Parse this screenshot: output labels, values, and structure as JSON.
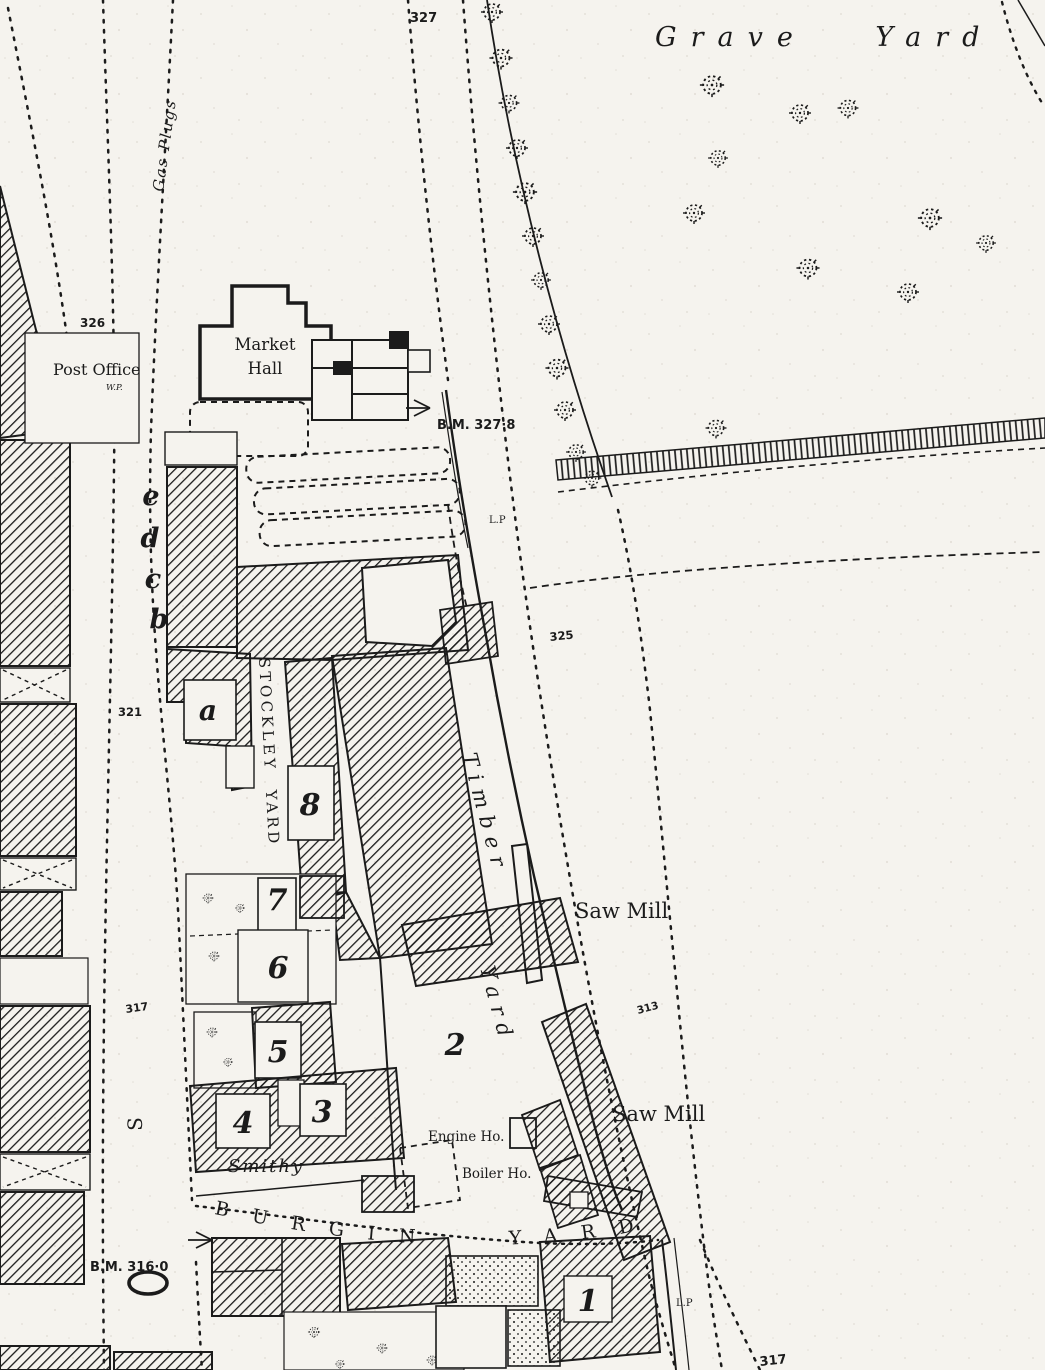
{
  "map": {
    "labels": {
      "grave_yard": "Grave Yard",
      "gas_plugs": "Gas Plugs",
      "post_office": "Post Office",
      "post_office_mark": "W.P.",
      "market_hall_line1": "Market",
      "market_hall_line2": "Hall",
      "benchmark_upper": "B.M. 327·8",
      "lamp_post_upper": "L.P",
      "stockley_yard": "STOCKLEY YARD",
      "timber": "Timber",
      "timber_yard": "Yard",
      "saw_mill_upper": "Saw Mill",
      "saw_mill_lower": "Saw Mill",
      "engine_house": "Engine Ho.",
      "boiler_house": "Boiler Ho.",
      "smithy": "Smithy",
      "burgin_yard": "BURGIN YARD",
      "benchmark_lower": "B.M. 316·0",
      "lamp_post_lower": "L.P",
      "street_letter": "S"
    },
    "spot_heights": {
      "h327": "327",
      "h326": "326",
      "h325": "325",
      "h321": "321",
      "h317": "317",
      "h313": "313",
      "h317_south": "317"
    },
    "red_annotations": {
      "a": "a",
      "b": "b",
      "c": "c",
      "d": "d",
      "e": "e",
      "n1": "1",
      "n2": "2",
      "n3": "3",
      "n4": "4",
      "n5": "5",
      "n6": "6",
      "n7": "7",
      "n8": "8"
    },
    "colors": {
      "paper": "#f5f3ee",
      "ink": "#1b1b1b",
      "red_annotation": "#c82f2f"
    }
  }
}
